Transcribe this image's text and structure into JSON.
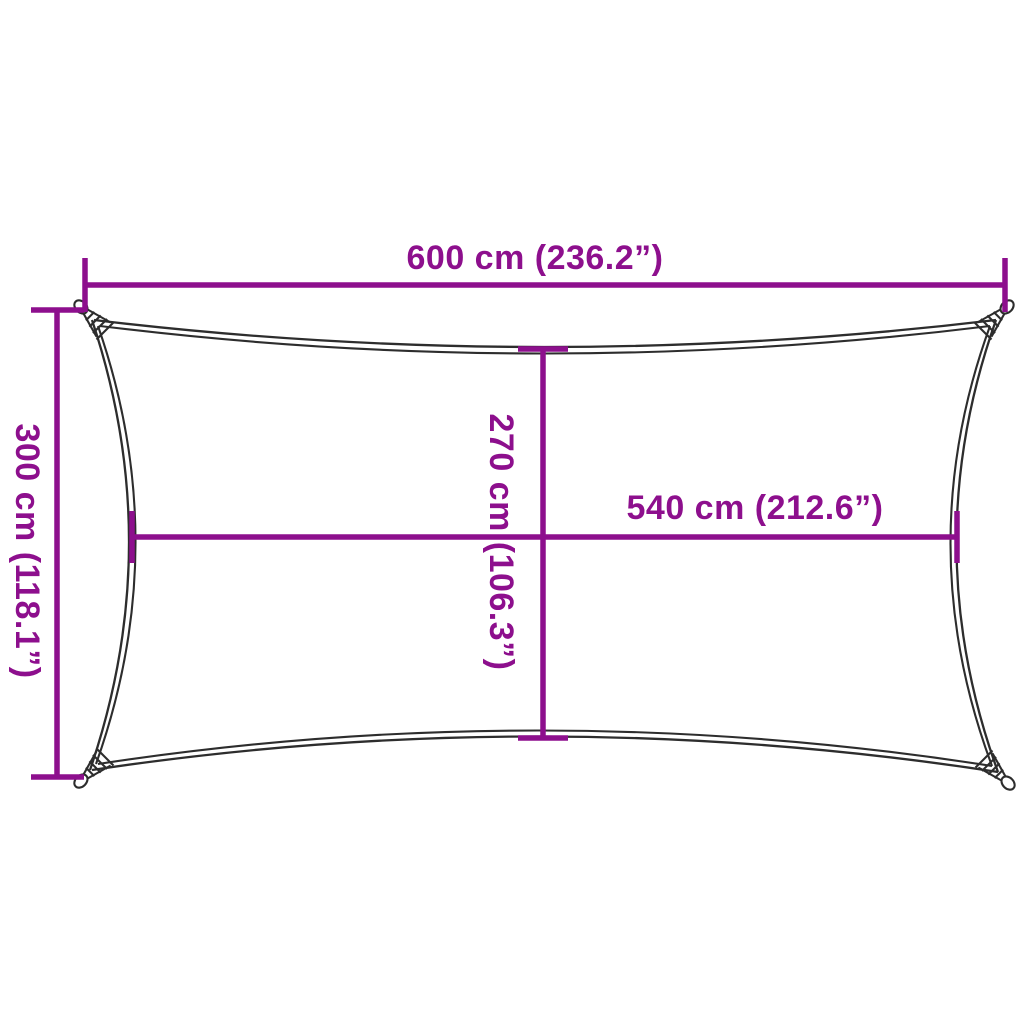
{
  "image": {
    "type": "product-dimension-diagram",
    "subject": "rectangular shade sail top-view outline with corner attachment rings",
    "background_color": "#ffffff",
    "outline_color": "#2d2d2d",
    "dimension_color": "#8d0f8d"
  },
  "dimensions": {
    "overall_width": {
      "label": "600 cm (236.2”)",
      "value_cm": 600,
      "value_in": 236.2
    },
    "overall_height": {
      "label": "300 cm (118.1”)",
      "value_cm": 300,
      "value_in": 118.1
    },
    "inner_height": {
      "label": "270 cm (106.3”)",
      "value_cm": 270,
      "value_in": 106.3
    },
    "inner_width": {
      "label": "540 cm (212.6”)",
      "value_cm": 540,
      "value_in": 212.6
    }
  }
}
